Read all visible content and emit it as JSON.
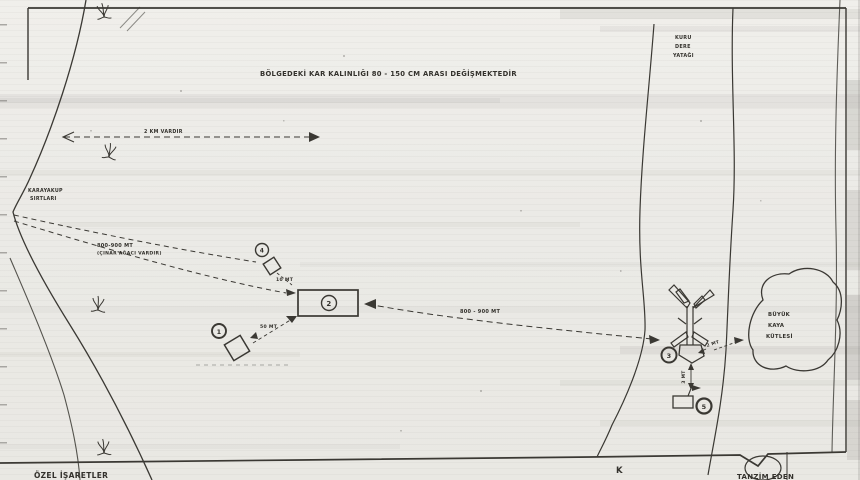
{
  "colors": {
    "paper": "#edece7",
    "ink": "#3a3833"
  },
  "notes": {
    "snow": "BÖLGEDEKİ KAR KALINLIĞI 80 - 150 CM ARASI DEĞİŞMEKTEDİR",
    "km": "2 KM VARDIR",
    "approach_distance": "800-900 MT",
    "approach_note": "(ÇINAR AĞACI VARDIR)",
    "mid_distance": "800 - 900 MT",
    "d10": "10 MT",
    "d50": "50 MT",
    "d2": "2 MT",
    "d3": "3 MT"
  },
  "features": {
    "ridge_l1": "KARAYAKUP",
    "ridge_l2": "SIRTLARI",
    "stream_l1": "KURU",
    "stream_l2": "DERE",
    "stream_l3": "YATAĞI",
    "rock_l1": "BÜYÜK",
    "rock_l2": "KAYA",
    "rock_l3": "KÜTLESİ"
  },
  "markers": {
    "m1": "1",
    "m2": "2",
    "m3": "3",
    "m4": "4",
    "m5": "5"
  },
  "footer": {
    "left": "ÖZEL İŞARETLER",
    "right": "TANZİM EDEN",
    "k": "K"
  }
}
